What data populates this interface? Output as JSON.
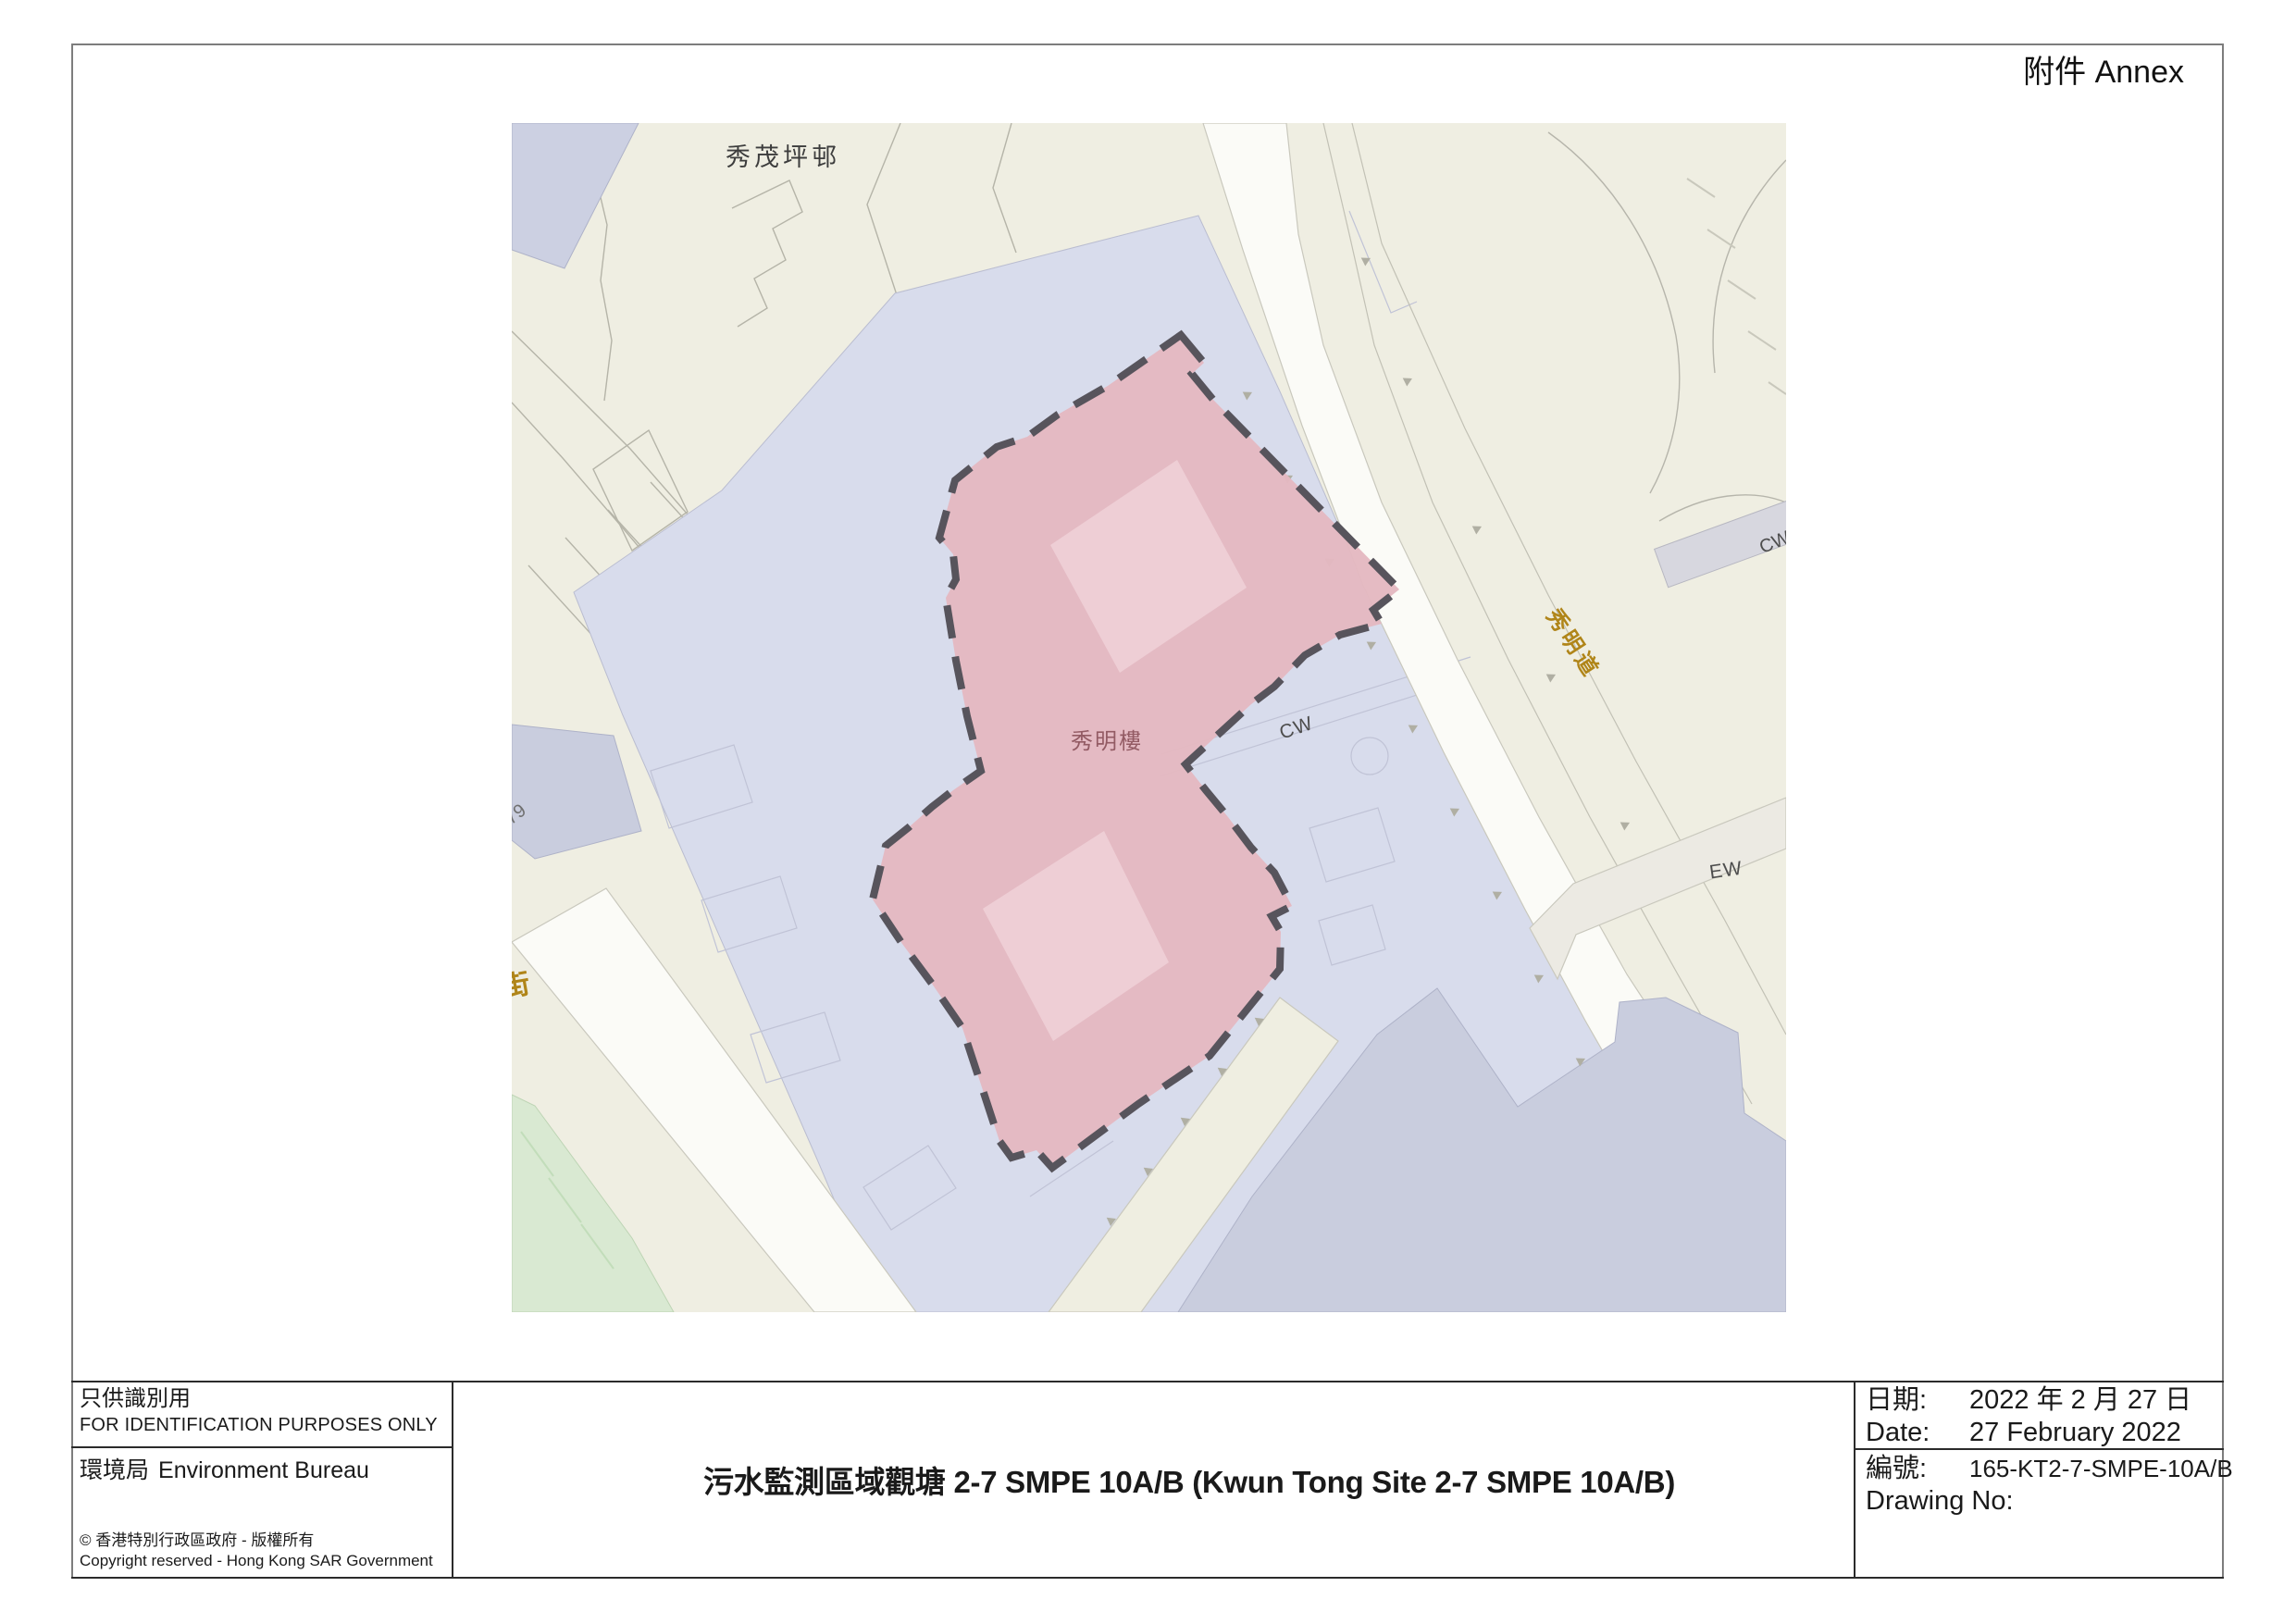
{
  "annex": "附件 Annex",
  "map": {
    "labels": {
      "estate_name": "秀茂坪邨",
      "site_building": "秀明樓",
      "road_name": "秀明道",
      "cw_area": "CW",
      "cw_edge": "CW",
      "ew_road": "EW",
      "lot_number": "79",
      "street_partial": "街",
      "street_partial_clipped": "坪"
    },
    "colors": {
      "site_fill": "#e4b8c1",
      "site_inner": "#eeced5",
      "site_outline": "#57545c",
      "road_label": "#b08519",
      "site_label": "#935b64"
    }
  },
  "footer": {
    "left": {
      "id_zh": "只供識別用",
      "id_en": "FOR IDENTIFICATION PURPOSES ONLY",
      "bureau_zh": "環境局",
      "bureau_en": "Environment Bureau",
      "copyright_zh": "©  香港特別行政區政府 - 版權所有",
      "copyright_en": "Copyright reserved - Hong Kong SAR Government"
    },
    "title": "污水監測區域觀塘 2-7 SMPE 10A/B (Kwun Tong Site 2-7 SMPE 10A/B)",
    "right": {
      "date_label_zh": "日期:",
      "date_value_zh": "2022 年 2 月 27 日",
      "date_label_en": "Date:",
      "date_value_en": "27 February 2022",
      "no_label_zh": "編號:",
      "no_value": "165-KT2-7-SMPE-10A/B",
      "no_label_en": "Drawing No:"
    }
  }
}
